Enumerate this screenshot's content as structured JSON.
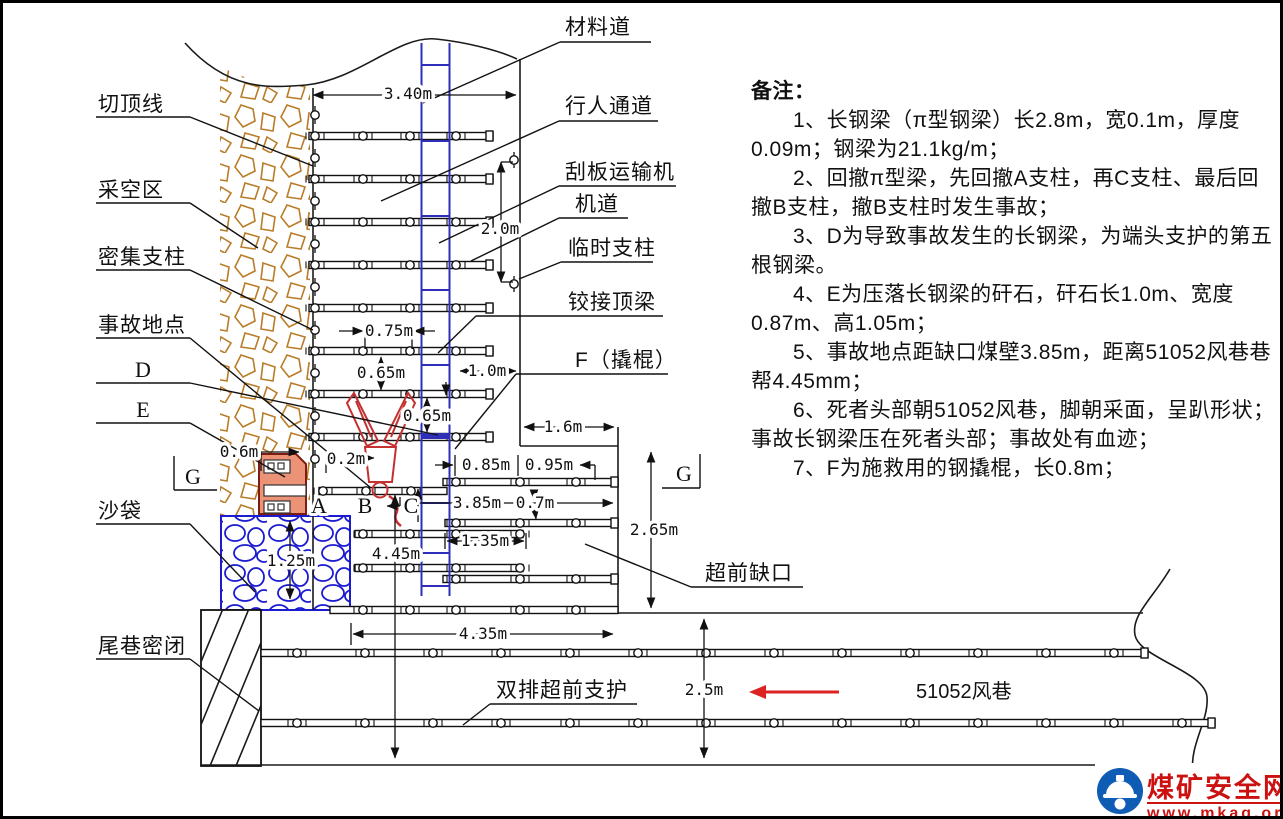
{
  "labels": {
    "cut_top_line": "切顶线",
    "goaf": "采空区",
    "dense_props": "密集支柱",
    "accident_spot": "事故地点",
    "sandbag": "沙袋",
    "tail_seal": "尾巷密闭",
    "material_road": "材料道",
    "pedestrian_way": "行人通道",
    "scraper_conveyor": "刮板运输机",
    "machine_road": "机道",
    "temp_prop": "临时支柱",
    "hinged_beam": "铰接顶梁",
    "f_crowbar": "F（撬棍）",
    "advance_notch": "超前缺口",
    "double_row_support": "双排超前支护",
    "airway_51052": "51052风巷"
  },
  "letters": {
    "a": "A",
    "b": "B",
    "c": "C",
    "d": "D",
    "e": "E",
    "g": "G"
  },
  "dims": {
    "top_width": "3.40m",
    "face_height": "2.0m",
    "prop_gap": "0.75m",
    "row_gap_a": "0.65m",
    "row_gap_b": "0.65m",
    "last_prop_to_wall": "1.0m",
    "notch_step": "1.6m",
    "rock_offset": "0.6m",
    "body_offset": "0.2m",
    "notch_prop_a": "0.85m",
    "notch_prop_b": "0.95m",
    "to_coal_wall": "3.85m",
    "row_pair_gap": "0.7m",
    "notch_height": "2.65m",
    "beam_overlap": "1.35m",
    "to_roadway": "4.45m",
    "notch_width": "4.35m",
    "sandbag_height": "1.25m",
    "roadway_width": "2.5m"
  },
  "notes": {
    "heading": "备注：",
    "items": [
      "1、长钢梁（π型钢梁）长2.8m，宽0.1m，厚度0.09m；钢梁为21.1kg/m；",
      "2、回撤π型梁，先回撤A支柱，再C支柱、最后回撤B支柱，撤B支柱时发生事故；",
      "3、D为导致事故发生的长钢梁，为端头支护的第五根钢梁。",
      "4、E为压落长钢梁的矸石，矸石长1.0m、宽度0.87m、高1.05m；",
      "5、事故地点距缺口煤壁3.85m，距离51052风巷巷帮4.45mm；",
      "6、死者头部朝51052风巷，脚朝采面，呈趴形状；事故长钢梁压在死者头部；事故处有血迹；",
      "7、F为施救用的钢撬棍，长0.8m；"
    ]
  },
  "watermark": {
    "site_name": "煤矿安全网",
    "site_url": "www.mkaq.org"
  },
  "colors": {
    "line": "#1a1a1a",
    "goaf_rock": "#b97c28",
    "sandbag_blue": "#1b1bd0",
    "conveyor_blue": "#2e2eb8",
    "rock_fill": "#ec9277",
    "rock_outline": "#7d1d12",
    "victim_red": "#c53030",
    "arrow_red": "#dd2222",
    "logo_red": "#cc1111",
    "logo_blue": "#0f5cb5"
  }
}
